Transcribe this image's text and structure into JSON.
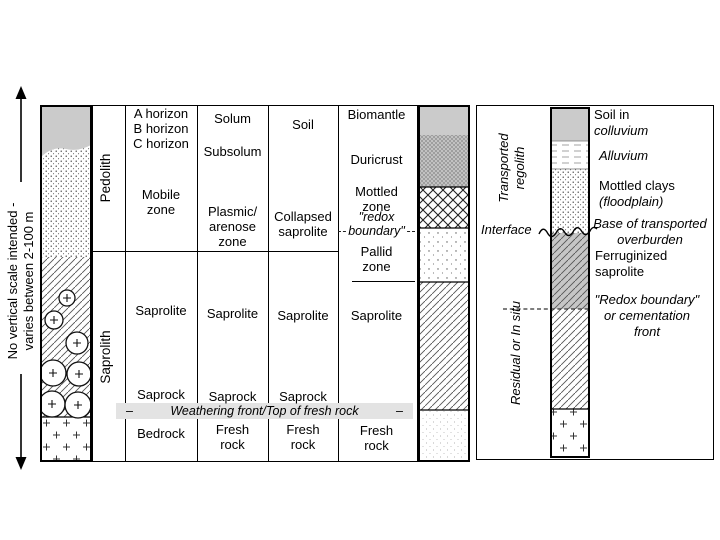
{
  "colors": {
    "ink": "#000000",
    "soil_gray": "#cbcbcb",
    "duricrust_gray": "#c9c9c9",
    "ferruginized_gray": "#c6c6c6",
    "highlight_band": "#e3e3e3",
    "background": "#ffffff"
  },
  "scale_note": {
    "line1": "No vertical scale intended -",
    "line2": "varies between 2-100 m"
  },
  "main": {
    "phase": {
      "pedolith": "Pedolith",
      "saprolith": "Saprolith"
    },
    "col1": {
      "a": "A horizon",
      "b": "B horizon",
      "c": "C horizon",
      "mobile1": "Mobile",
      "mobile2": "zone",
      "saprolite": "Saprolite",
      "saprock": "Saprock",
      "bedrock": "Bedrock"
    },
    "col2": {
      "solum": "Solum",
      "subsolum": "Subsolum",
      "plasmic1": "Plasmic/",
      "plasmic2": "arenose",
      "plasmic3": "zone",
      "saprolite": "Saprolite",
      "saprock": "Saprock",
      "fresh1": "Fresh",
      "fresh2": "rock"
    },
    "col3": {
      "soil": "Soil",
      "collapsed1": "Collapsed",
      "collapsed2": "saprolite",
      "saprolite": "Saprolite",
      "saprock": "Saprock",
      "fresh1": "Fresh",
      "fresh2": "rock"
    },
    "col4": {
      "biomantle": "Biomantle",
      "duricrust": "Duricrust",
      "mottled1": "Mottled",
      "mottled2": "zone",
      "redox1": "\"redox",
      "redox2": "boundary\"",
      "pallid1": "Pallid",
      "pallid2": "zone",
      "saprolite": "Saprolite",
      "fresh1": "Fresh",
      "fresh2": "rock"
    },
    "weathering_front": "Weathering front/Top of fresh rock",
    "dash_left": "–",
    "dash_right": "–"
  },
  "right_panel": {
    "transported1": "Transported",
    "transported2": "regolith",
    "residual": "Residual or In situ",
    "interface": "Interface",
    "labels": {
      "soil1": "Soil in",
      "soil2": "colluvium",
      "alluvium": "Alluvium",
      "mottled1": "Mottled clays",
      "mottled2": "(floodplain)",
      "base1": "Base of transported",
      "base2": "overburden",
      "ferr1": "Ferruginized",
      "ferr2": "saprolite",
      "redox1": "\"Redox boundary\"",
      "redox2": "or cementation",
      "redox3": "front"
    }
  }
}
